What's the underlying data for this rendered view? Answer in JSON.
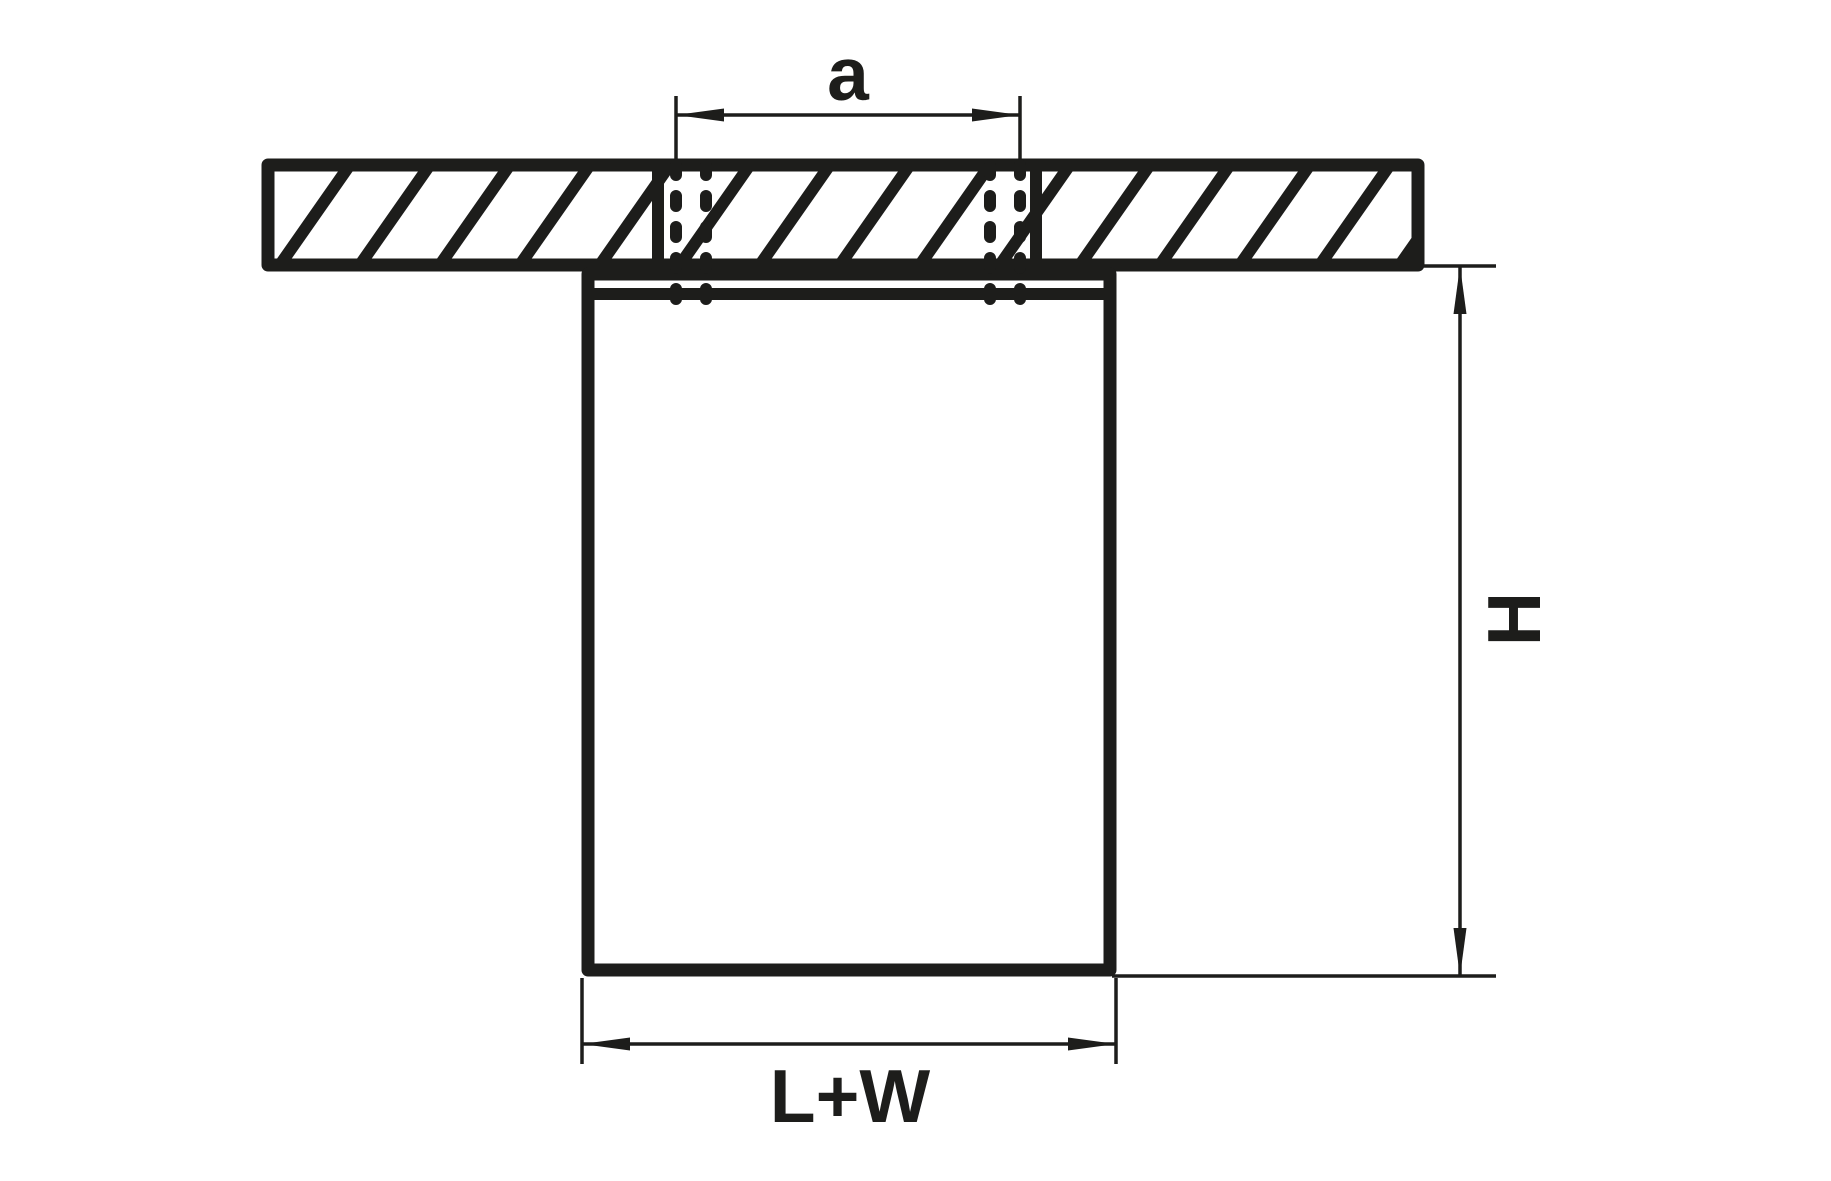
{
  "drawing": {
    "background_color": "#ffffff",
    "line_color": "#1d1d1b",
    "labels": {
      "screw_spacing": "a",
      "height": "H",
      "width": "L+W"
    }
  }
}
